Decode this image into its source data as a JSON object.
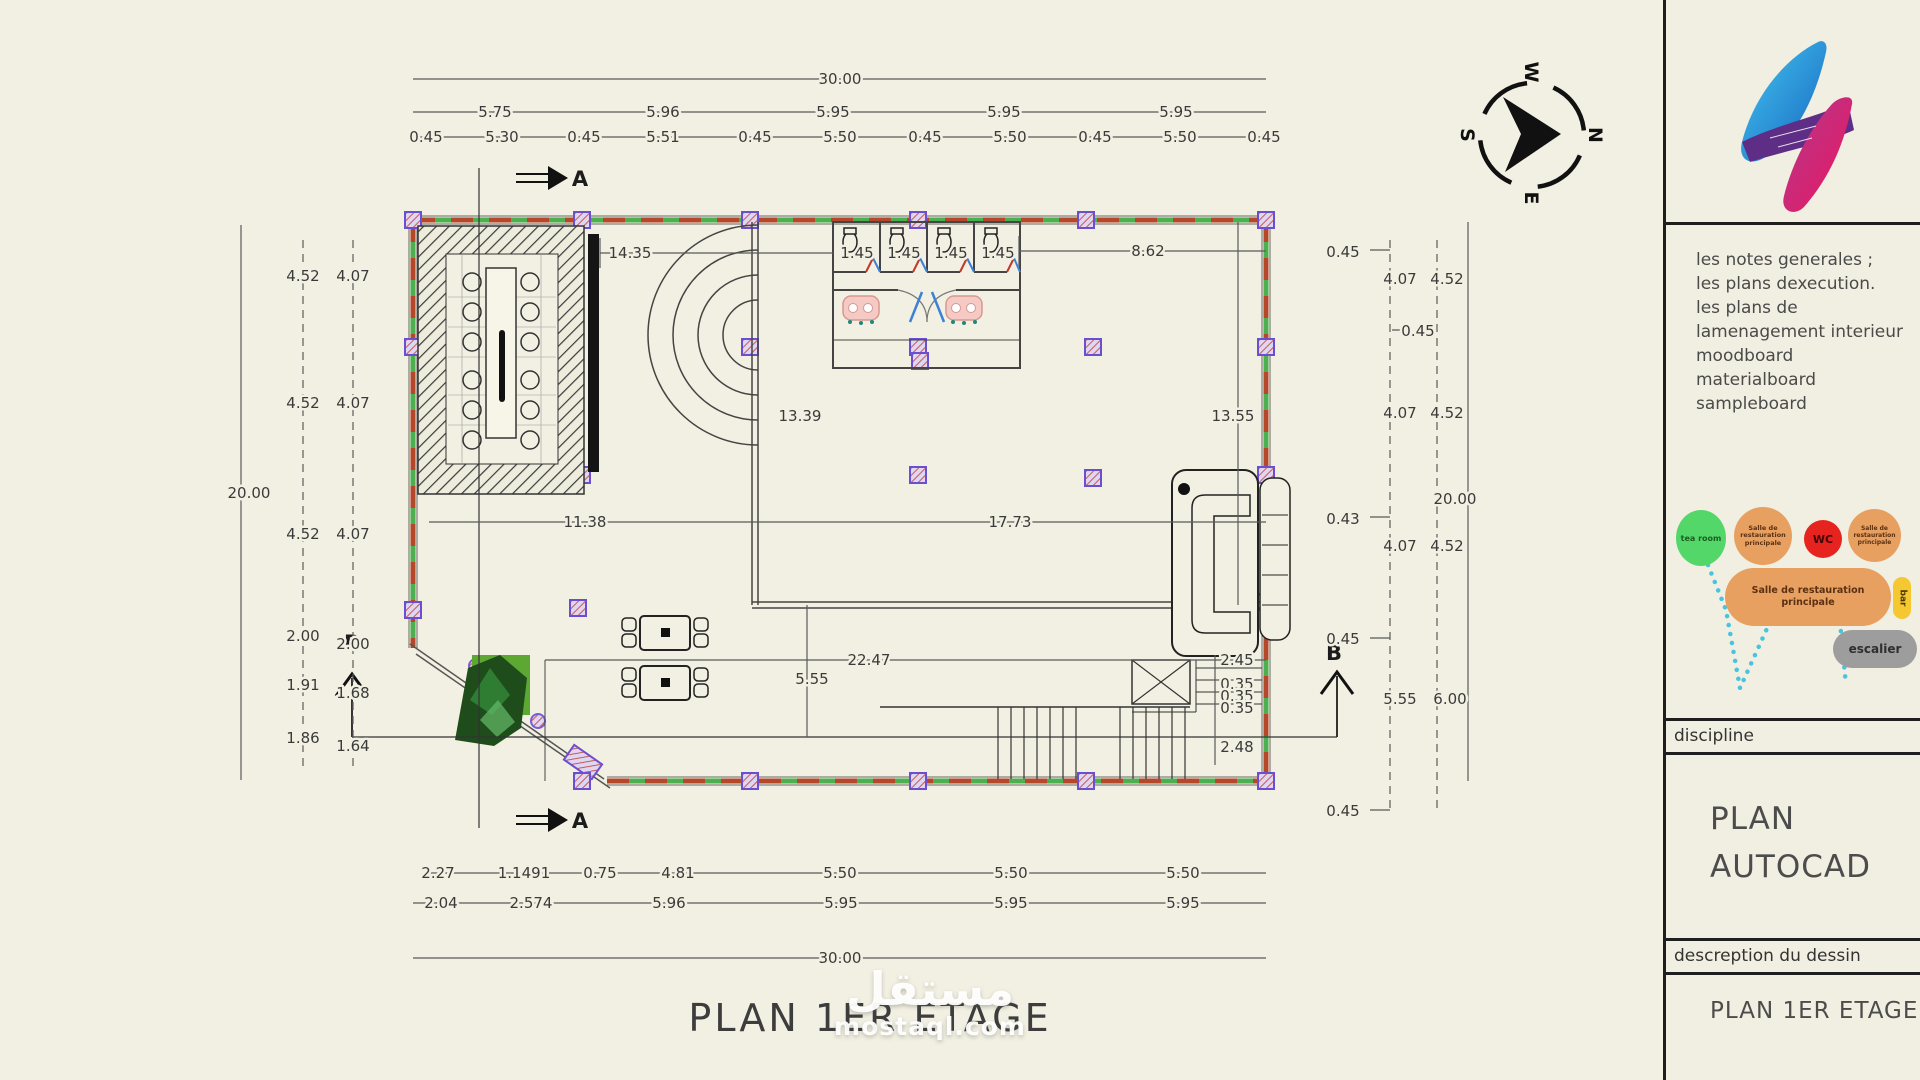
{
  "sheet": {
    "title": "PLAN 1ER ETAGE"
  },
  "watermark": {
    "arabic": "مستقل",
    "domain": "mostaql.com"
  },
  "compass": {
    "north": "N",
    "south": "S",
    "east": "E",
    "west": "W"
  },
  "panel": {
    "notes": [
      "les notes generales ;",
      "les plans dexecution.",
      "les plans de",
      "lamenagement interieur",
      "moodboard",
      "materialboard",
      "sampleboard"
    ],
    "bubbles": {
      "tea_room": "tea room",
      "salle_small": "Salle de restauration principale",
      "wc": "WC",
      "salle_main": "Salle de restauration principale",
      "bar": "bar",
      "escalier": "escalier"
    },
    "discipline_label": "discipline",
    "discipline_value_line1": "PLAN",
    "discipline_value_line2": "AUTOCAD",
    "description_label": "descreption du dessin",
    "description_value": "PLAN 1ER ETAGE"
  },
  "dims": {
    "top_total": "30.00",
    "top_row2": [
      "5.75",
      "5.96",
      "5.95",
      "5.95",
      "5.95"
    ],
    "top_row3": [
      "0.45",
      "5.30",
      "0.45",
      "5.51",
      "0.45",
      "5.50",
      "0.45",
      "5.50",
      "0.45",
      "5.50",
      "0.45"
    ],
    "left_pairs": [
      [
        "4.52",
        "4.07"
      ],
      [
        "4.52",
        "4.07"
      ],
      [
        "4.52",
        "4.07"
      ],
      [
        "2.00",
        "2.00"
      ],
      [
        "1.91",
        "1.68"
      ],
      [
        "1.86",
        "1.64"
      ]
    ],
    "left_total": "20.00",
    "right_col": [
      "0.45",
      "0.45",
      "0.43",
      "0.45",
      "0.45"
    ],
    "right_pairs": [
      [
        "4.07",
        "4.52"
      ],
      [
        "4.07",
        "4.52"
      ],
      [
        "4.07",
        "4.52"
      ],
      [
        "5.55",
        "6.00"
      ]
    ],
    "right_total": "20.00",
    "bottom_row1": [
      "2.27",
      "1.1491",
      "0.75",
      "4.81",
      "5.50",
      "5.50",
      "5.50"
    ],
    "bottom_row2": [
      "2.04",
      "2.574",
      "5.96",
      "5.95",
      "5.95",
      "5.95"
    ],
    "bottom_total": "30.00",
    "interior": {
      "left_top": "14.35",
      "stalls": [
        "1.45",
        "1.45",
        "1.45",
        "1.45"
      ],
      "right_top": "8.62",
      "mid_left": "13.39",
      "mid_right": "13.55",
      "lower_left": "11.38",
      "lower_right": "17.73",
      "hall_width": "22.47",
      "hall_bay": "5.55",
      "stair_top": "2.45",
      "stair_risers": [
        "0.35",
        "0.35",
        "0.35"
      ],
      "stair_width": "2.48"
    },
    "section_a": "A",
    "section_b": "B"
  }
}
